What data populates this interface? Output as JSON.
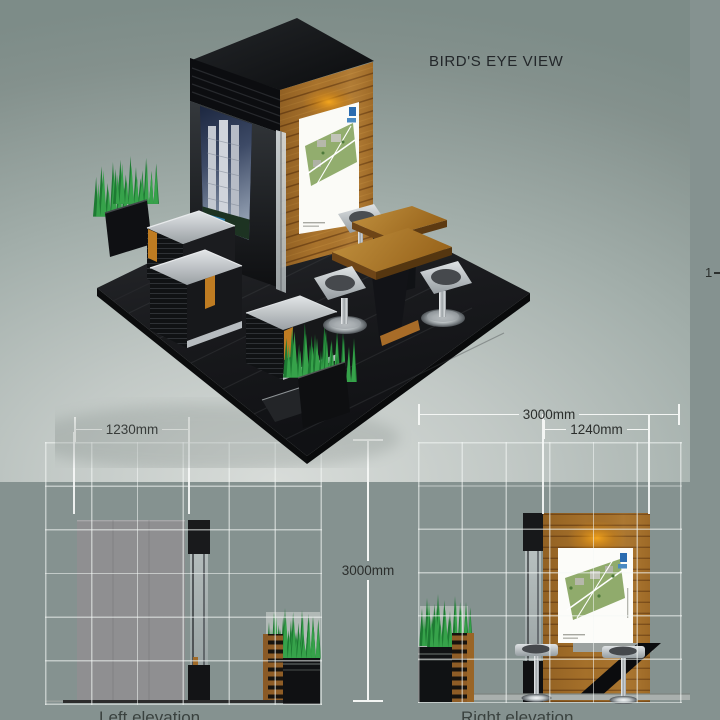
{
  "title": {
    "birdseye": "BIRD'S EYE VIEW"
  },
  "dimensions": {
    "left_panel_width": "1230mm",
    "booth_width": "3000mm",
    "wood_wall_width": "1240mm",
    "booth_height": "3000mm",
    "edge_fragment": "1"
  },
  "labels": {
    "left_elevation": "Left elevation",
    "right_elevation": "Right elevation"
  },
  "colors": {
    "page_background": "#859290",
    "backdrop_highlight": "#D8DCD9",
    "grid_line": "#F4F8F6",
    "dimension_line": "#F4F6F4",
    "dimension_text": "#2B2E2C",
    "wood": "#A5702A",
    "accent_orange": "#BF7C22",
    "grass_green": "#36A24A",
    "dark_panel": "#141518",
    "poster_blue": "#2B6CB0"
  }
}
